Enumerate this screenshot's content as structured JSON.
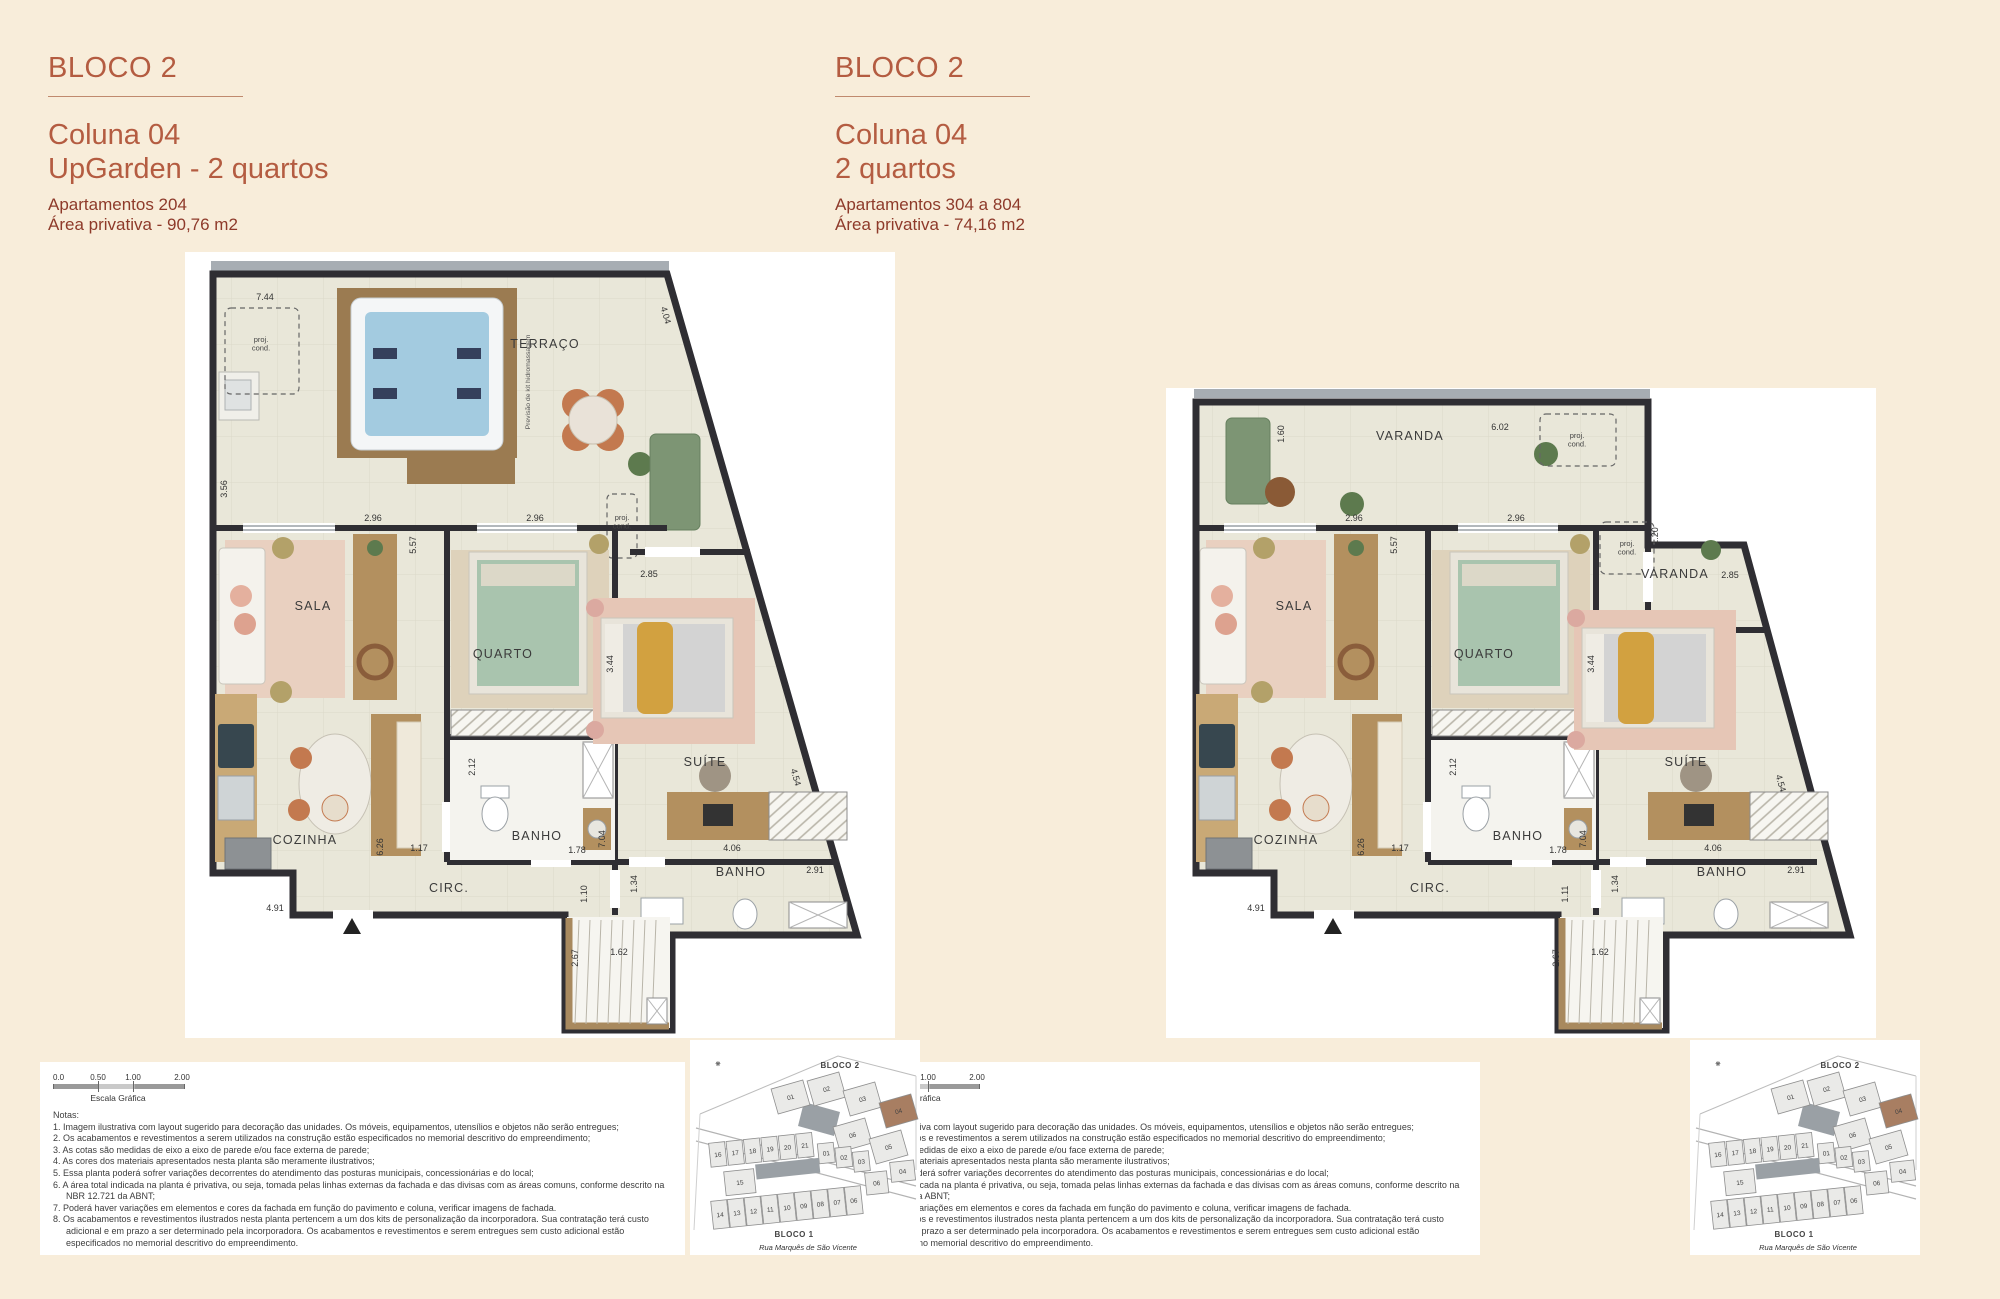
{
  "colors": {
    "background": "#f8edda",
    "accent": "#b45c41",
    "detail": "#8e3a2a",
    "wall": "#2f2e33",
    "floor": "#e9e7d9",
    "highlight_unit": "#a87e62"
  },
  "panels": [
    {
      "block_label": "BLOCO 2",
      "title_line1": "Coluna 04",
      "title_line2": "UpGarden - 2 quartos",
      "detail_line1": "Apartamentos 204",
      "detail_line2": "Área privativa - 90,76 m2"
    },
    {
      "block_label": "BLOCO 2",
      "title_line1": "Coluna 04",
      "title_line2": "2 quartos",
      "detail_line1": "Apartamentos 304 a 804",
      "detail_line2": "Área privativa - 74,16 m2"
    }
  ],
  "scale": {
    "labels": [
      "0.0",
      "0.50",
      "1.00",
      "2.00"
    ],
    "caption": "Escala Gráfica"
  },
  "notes": {
    "title": "Notas:",
    "items": [
      "1. Imagem ilustrativa com layout sugerido para decoração das unidades. Os móveis, equipamentos, utensílios e objetos não serão entregues;",
      "2. Os acabamentos e revestimentos a serem utilizados na construção estão especificados no memorial descritivo do empreendimento;",
      "3. As cotas são medidas de eixo a eixo de parede e/ou face externa de parede;",
      "4. As cores dos materiais apresentados nesta planta são meramente ilustrativos;",
      "5. Essa planta poderá sofrer variações decorrentes do atendimento das posturas municipais, concessionárias e do local;",
      "6. A área total indicada na planta é privativa, ou seja, tomada pelas linhas externas da fachada e das divisas com as áreas comuns, conforme descrito na NBR 12.721 da ABNT;",
      "7. Poderá haver variações em elementos e cores da fachada em função do pavimento e coluna, verificar imagens de fachada.",
      "8. Os acabamentos e revestimentos ilustrados nesta planta pertencem a um dos kits de personalização da incorporadora. Sua contratação terá custo adicional e em prazo a ser determinado pela incorporadora. Os acabamentos e revestimentos e serem entregues sem custo adicional estão especificados  no memorial descritivo do empreendimento."
    ]
  },
  "site_map": {
    "bloco2_label": "BLOCO 2",
    "bloco1_label": "BLOCO 1",
    "street": "Rua Marquês de São Vicente",
    "bloco2_units": [
      "01",
      "02",
      "03",
      "04",
      "06",
      "05"
    ],
    "highlight_unit": "04",
    "bloco1_top": [
      "16",
      "17",
      "18",
      "19",
      "20",
      "21"
    ],
    "bloco1_mid": [
      "01",
      "02",
      "03"
    ],
    "bloco1_cell15": "15",
    "bloco1_right": [
      "06",
      "04"
    ],
    "bloco1_bottom": [
      "14",
      "13",
      "12",
      "11",
      "10",
      "09",
      "08",
      "07",
      "06"
    ]
  },
  "plan_left": {
    "labels": [
      {
        "t": "TERRAÇO",
        "x": 360,
        "y": 96,
        "k": "room"
      },
      {
        "t": "SALA",
        "x": 128,
        "y": 358,
        "k": "room"
      },
      {
        "t": "QUARTO",
        "x": 318,
        "y": 406,
        "k": "room"
      },
      {
        "t": "SUÍTE",
        "x": 520,
        "y": 514,
        "k": "room"
      },
      {
        "t": "COZINHA",
        "x": 120,
        "y": 592,
        "k": "room"
      },
      {
        "t": "BANHO",
        "x": 352,
        "y": 588,
        "k": "room"
      },
      {
        "t": "CIRC.",
        "x": 264,
        "y": 640,
        "k": "room"
      },
      {
        "t": "BANHO",
        "x": 556,
        "y": 624,
        "k": "room"
      },
      {
        "t": "7.44",
        "x": 80,
        "y": 48,
        "k": "dim"
      },
      {
        "t": "4.04",
        "x": 478,
        "y": 64,
        "r": 74,
        "k": "dim"
      },
      {
        "t": "3.56",
        "x": 42,
        "y": 237,
        "r": -90,
        "k": "dim"
      },
      {
        "t": "2.96",
        "x": 188,
        "y": 269,
        "k": "dim"
      },
      {
        "t": "5.57",
        "x": 231,
        "y": 293,
        "r": -90,
        "k": "dim"
      },
      {
        "t": "2.96",
        "x": 350,
        "y": 269,
        "k": "dim"
      },
      {
        "t": "2.85",
        "x": 464,
        "y": 325,
        "k": "dim"
      },
      {
        "t": "3.44",
        "x": 428,
        "y": 412,
        "r": -90,
        "k": "dim"
      },
      {
        "t": "2.12",
        "x": 290,
        "y": 515,
        "r": -90,
        "k": "dim"
      },
      {
        "t": "6.26",
        "x": 198,
        "y": 595,
        "r": -90,
        "k": "dim"
      },
      {
        "t": "1.17",
        "x": 234,
        "y": 599,
        "k": "dim"
      },
      {
        "t": "1.78",
        "x": 392,
        "y": 601,
        "k": "dim"
      },
      {
        "t": "7.04",
        "x": 420,
        "y": 587,
        "r": -90,
        "k": "dim"
      },
      {
        "t": "1.34",
        "x": 452,
        "y": 632,
        "r": -90,
        "k": "dim"
      },
      {
        "t": "4.06",
        "x": 547,
        "y": 599,
        "k": "dim"
      },
      {
        "t": "2.91",
        "x": 630,
        "y": 621,
        "k": "dim"
      },
      {
        "t": "4.54",
        "x": 608,
        "y": 526,
        "r": 74,
        "k": "dim"
      },
      {
        "t": "4.91",
        "x": 90,
        "y": 659,
        "k": "dim"
      },
      {
        "t": "1.10",
        "x": 402,
        "y": 642,
        "r": -90,
        "k": "dim"
      },
      {
        "t": "2.67",
        "x": 393,
        "y": 706,
        "r": -90,
        "k": "dim"
      },
      {
        "t": "1.62",
        "x": 434,
        "y": 703,
        "k": "dim"
      },
      {
        "t": "Previsão de kit hidromassagem",
        "x": 345,
        "y": 130,
        "r": -90,
        "k": "tiny"
      },
      {
        "t": "proj.",
        "t2": "cond.",
        "x": 76,
        "y": 90,
        "k": "pc"
      },
      {
        "t": "proj.",
        "t2": "cond.",
        "x": 437,
        "y": 268,
        "k": "pc"
      }
    ]
  },
  "plan_right": {
    "labels": [
      {
        "t": "VARANDA",
        "x": 244,
        "y": 188,
        "k": "room"
      },
      {
        "t": "VARANDA",
        "x": 509,
        "y": 326,
        "k": "room"
      },
      {
        "t": "SALA",
        "x": 128,
        "y": 358,
        "k": "room"
      },
      {
        "t": "QUARTO",
        "x": 318,
        "y": 406,
        "k": "room"
      },
      {
        "t": "SUÍTE",
        "x": 520,
        "y": 514,
        "k": "room"
      },
      {
        "t": "COZINHA",
        "x": 120,
        "y": 592,
        "k": "room"
      },
      {
        "t": "BANHO",
        "x": 352,
        "y": 588,
        "k": "room"
      },
      {
        "t": "CIRC.",
        "x": 264,
        "y": 640,
        "k": "room"
      },
      {
        "t": "BANHO",
        "x": 556,
        "y": 624,
        "k": "room"
      },
      {
        "t": "1.60",
        "x": 118,
        "y": 182,
        "r": -90,
        "k": "dim"
      },
      {
        "t": "6.02",
        "x": 334,
        "y": 178,
        "k": "dim"
      },
      {
        "t": "1.20",
        "x": 492,
        "y": 284,
        "r": -90,
        "k": "dim"
      },
      {
        "t": "2.85",
        "x": 564,
        "y": 326,
        "k": "dim"
      },
      {
        "t": "2.96",
        "x": 188,
        "y": 269,
        "k": "dim"
      },
      {
        "t": "5.57",
        "x": 231,
        "y": 293,
        "r": -90,
        "k": "dim"
      },
      {
        "t": "2.96",
        "x": 350,
        "y": 269,
        "k": "dim"
      },
      {
        "t": "3.44",
        "x": 428,
        "y": 412,
        "r": -90,
        "k": "dim"
      },
      {
        "t": "2.12",
        "x": 290,
        "y": 515,
        "r": -90,
        "k": "dim"
      },
      {
        "t": "6.26",
        "x": 198,
        "y": 595,
        "r": -90,
        "k": "dim"
      },
      {
        "t": "1.17",
        "x": 234,
        "y": 599,
        "k": "dim"
      },
      {
        "t": "1.78",
        "x": 392,
        "y": 601,
        "k": "dim"
      },
      {
        "t": "7.04",
        "x": 420,
        "y": 587,
        "r": -90,
        "k": "dim"
      },
      {
        "t": "1.34",
        "x": 452,
        "y": 632,
        "r": -90,
        "k": "dim"
      },
      {
        "t": "4.06",
        "x": 547,
        "y": 599,
        "k": "dim"
      },
      {
        "t": "2.91",
        "x": 630,
        "y": 621,
        "k": "dim"
      },
      {
        "t": "4.54",
        "x": 612,
        "y": 532,
        "r": 74,
        "k": "dim"
      },
      {
        "t": "4.91",
        "x": 90,
        "y": 659,
        "k": "dim"
      },
      {
        "t": "1.11",
        "x": 402,
        "y": 642,
        "r": -90,
        "k": "dim"
      },
      {
        "t": "2.67",
        "x": 393,
        "y": 706,
        "r": -90,
        "k": "dim"
      },
      {
        "t": "1.62",
        "x": 434,
        "y": 703,
        "k": "dim"
      },
      {
        "t": "proj.",
        "t2": "cond.",
        "x": 411,
        "y": 186,
        "k": "pc"
      },
      {
        "t": "proj.",
        "t2": "cond.",
        "x": 461,
        "y": 294,
        "k": "pc"
      }
    ]
  }
}
